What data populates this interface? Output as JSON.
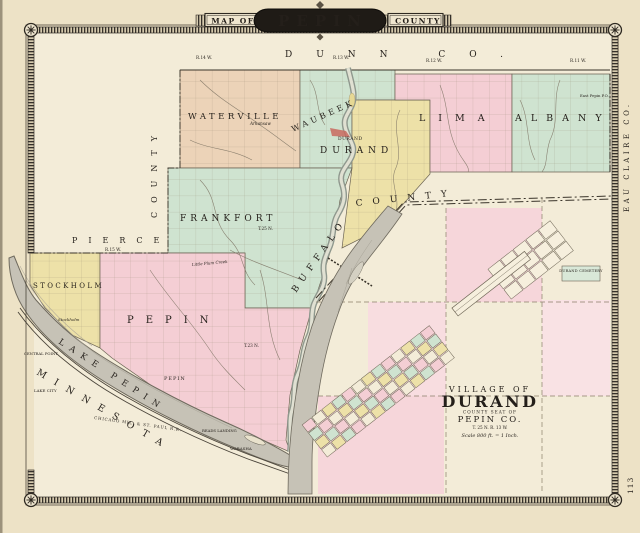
{
  "page": {
    "number": "113"
  },
  "banner": {
    "map_of": "MAP OF",
    "name": "PEPIN",
    "county_word": "COUNTY"
  },
  "counties": {
    "dunn": "DUNN CO.",
    "eau_claire": "EAU CLAIRE CO.",
    "pierce": "PIERCE",
    "pierce_vertical": "COUNTY",
    "buffalo": "BUFFALO",
    "buffalo_word2": "COUNTY"
  },
  "state": {
    "minnesota": "MINNESOTA"
  },
  "townships": {
    "waterville": "WATERVILLE",
    "waubeek": "WAUBEEK",
    "frankfort": "FRANKFORT",
    "durand": "DURAND",
    "lima": "LIMA",
    "albany": "ALBANY",
    "stockholm": "STOCKHOLM",
    "pepin": "PEPIN"
  },
  "villages": {
    "durand": "DURAND",
    "arkansaw": "Arkansaw",
    "east_pepin": "East Pepin P.O.",
    "stockholm": "Stockholm",
    "pepin": "PEPIN"
  },
  "minnesota_places": {
    "central_point": "CENTRAL POINT",
    "lake_city": "LAKE CITY",
    "reads_landing": "READS LANDING",
    "wabasha": "WABASHA"
  },
  "water": {
    "lake_pepin": "LAKE PEPIN"
  },
  "railroad": {
    "name": "CHICAGO MIL. & ST. PAUL R.R."
  },
  "survey": {
    "r15": "R.15 W.",
    "r14": "R.14 W.",
    "r13": "R.13 W.",
    "r12": "R.12 W.",
    "r11": "R.11 W.",
    "t25": "T.25 N.",
    "t23": "T.23 N."
  },
  "features": {
    "little_plum_creek": "Little Plum Creek",
    "durand_cemetery": "DURAND CEMETERY"
  },
  "inset": {
    "village_of": "VILLAGE OF",
    "name": "DURAND",
    "seat": "COUNTY SEAT OF",
    "county": "PEPIN CO.",
    "township_range": "T. 25 N.  R. 13 W.",
    "scale": "Scale 800 ft. = 1 Inch."
  },
  "colors": {
    "paper": "#ede2c6",
    "map_paper": "#f3ecd8",
    "tan": "#ecd3b8",
    "green": "#cfe3d0",
    "yellow": "#ede1a8",
    "pink": "#f4ced4",
    "water_gray": "#c6c2b6",
    "ink": "#241f1a",
    "band": "#35302a",
    "village_red": "#c96a5f"
  }
}
